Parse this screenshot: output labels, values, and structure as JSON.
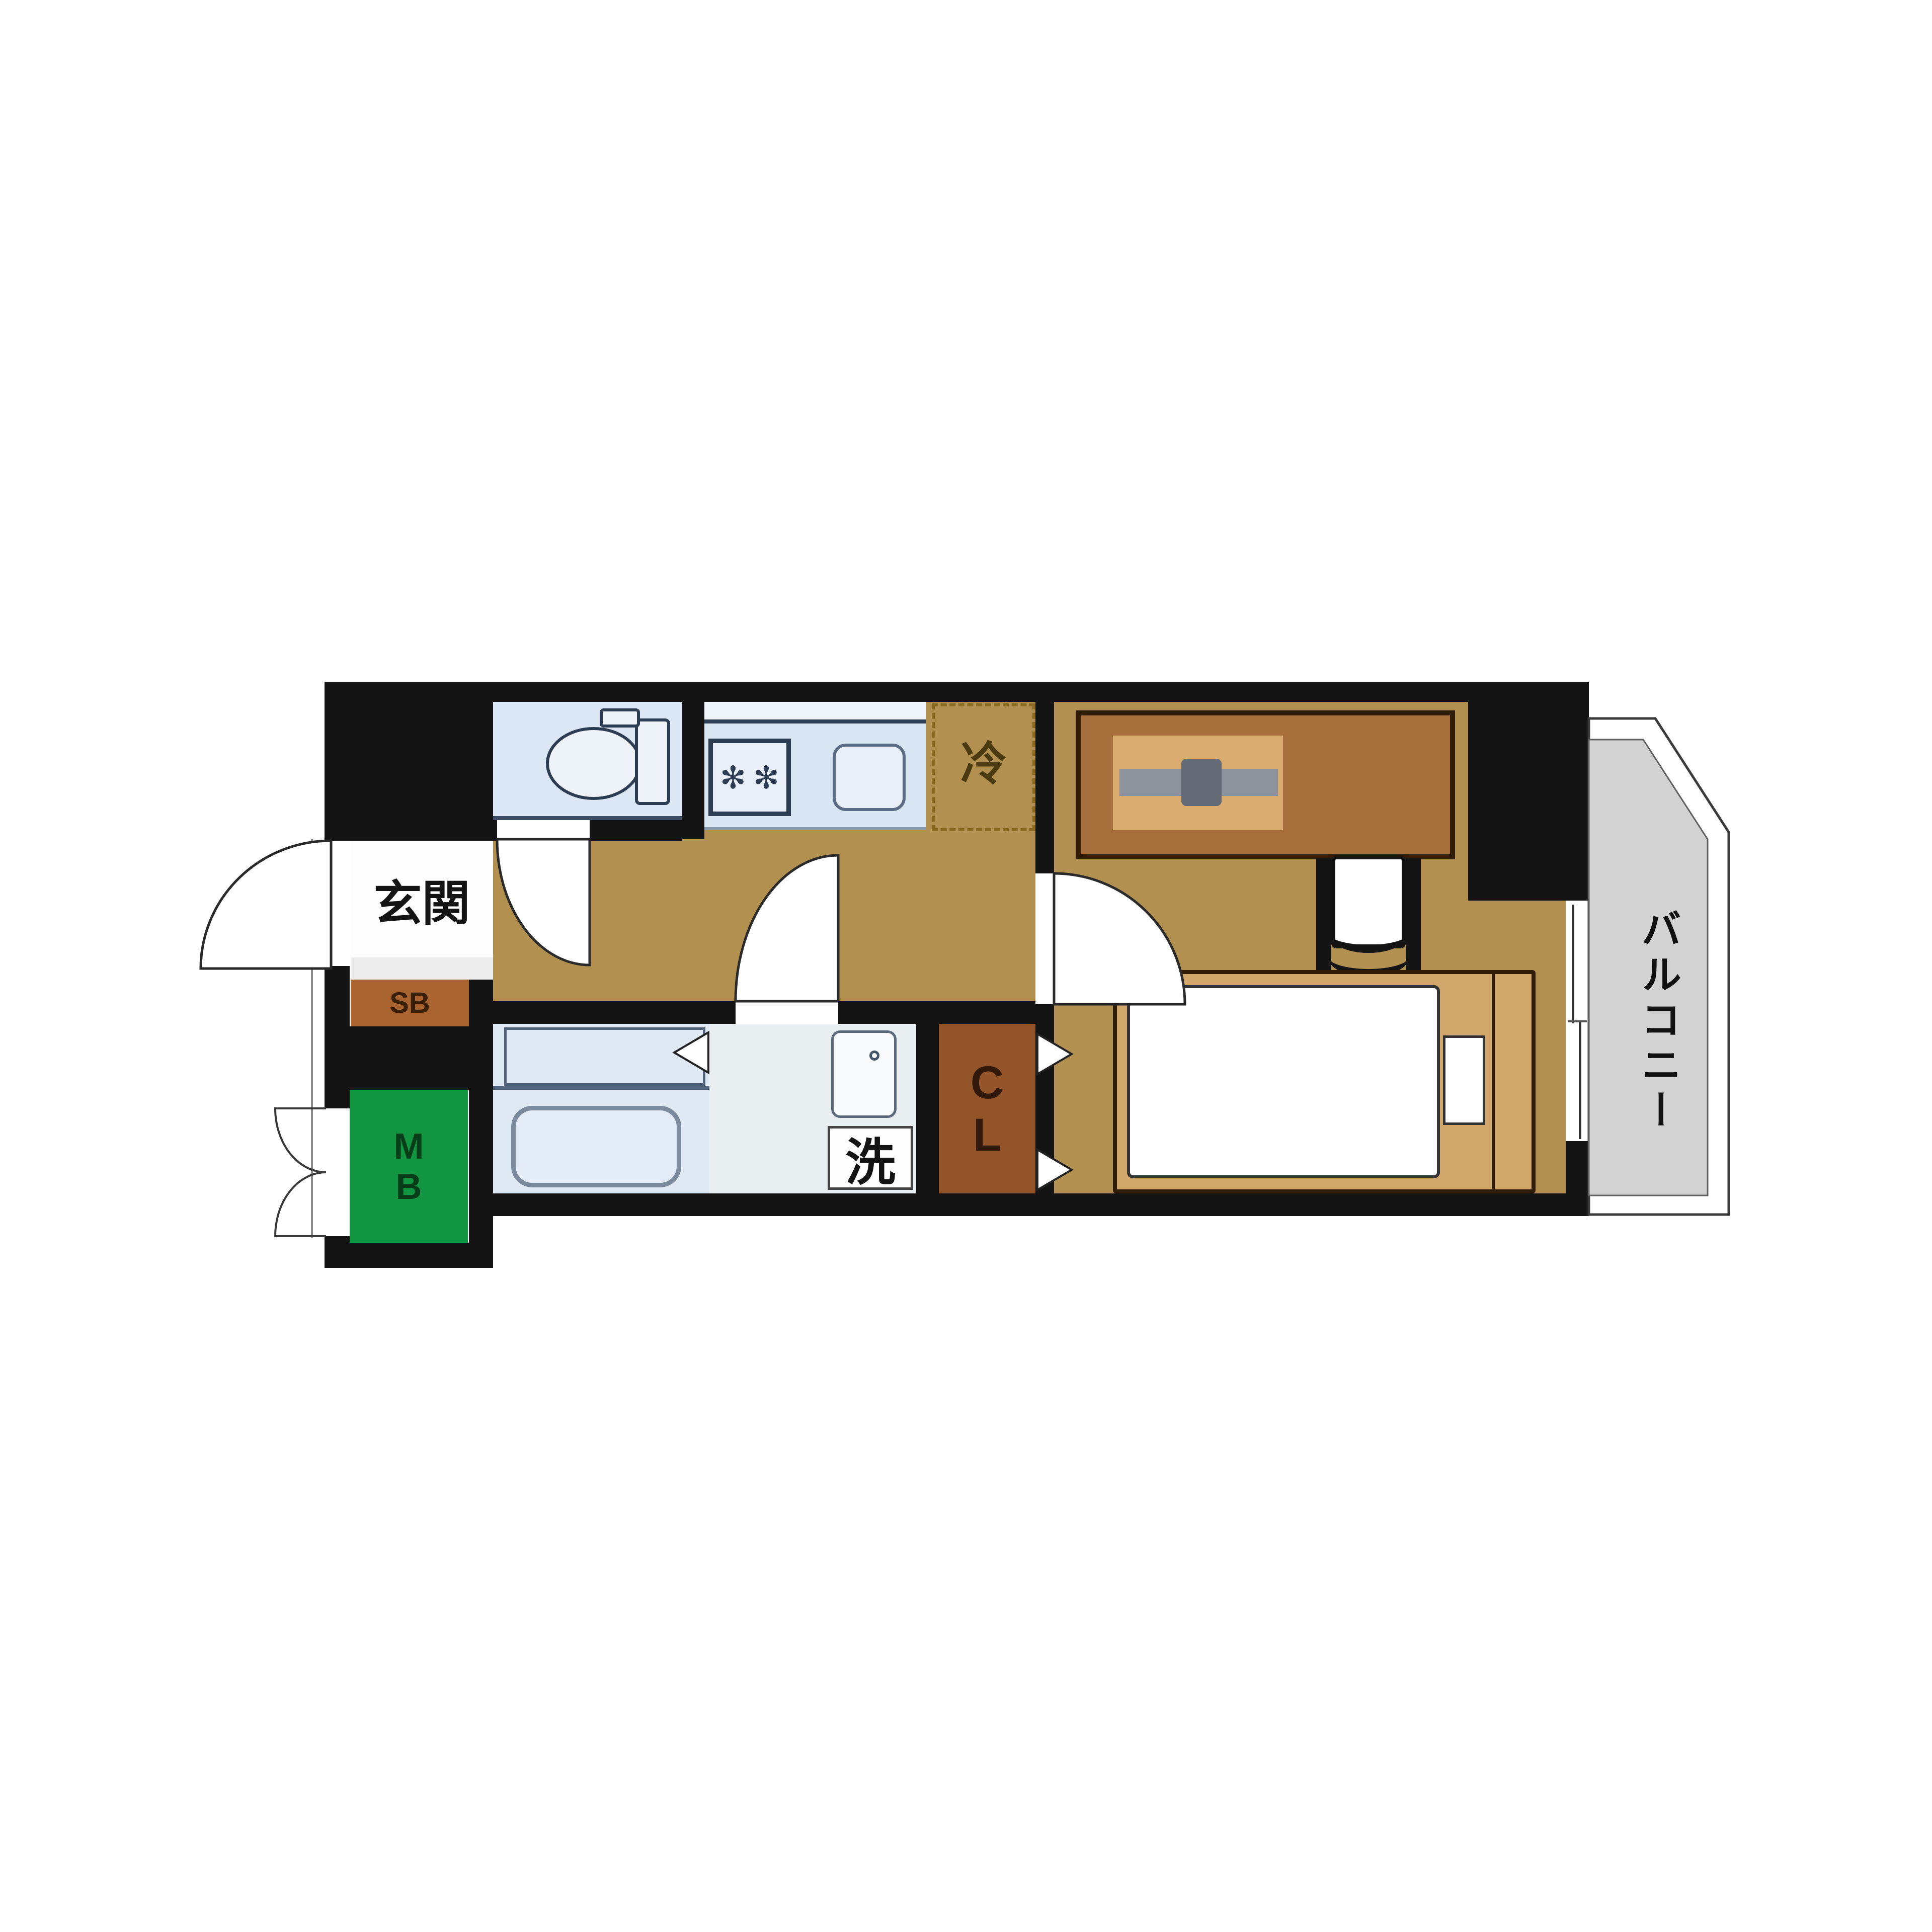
{
  "plan": {
    "labels": {
      "entrance": "玄関",
      "shoe_box": "SB",
      "meter_box_line1": "M",
      "meter_box_line2": "B",
      "refrigerator": "冷",
      "washing_machine": "洗",
      "closet_line1": "C",
      "closet_line2": "L",
      "balcony": "バルコニー"
    },
    "icons": {
      "stove_burner": "✻"
    },
    "colors": {
      "wall_black": "#141414",
      "wood_floor_tan": "#b29050",
      "wet_area_blue": "#dbe7f4",
      "washroom_white": "#e9eff1",
      "balcony_gray": "#d2d2d2",
      "closet_brown": "#93542a",
      "shoe_box_brown": "#a8632f",
      "meter_box_green": "#129540",
      "bed_desk_wood": "#d2a76b",
      "desk_brown": "#a8703d",
      "fixture_outline_navy": "#2c3c52"
    }
  }
}
